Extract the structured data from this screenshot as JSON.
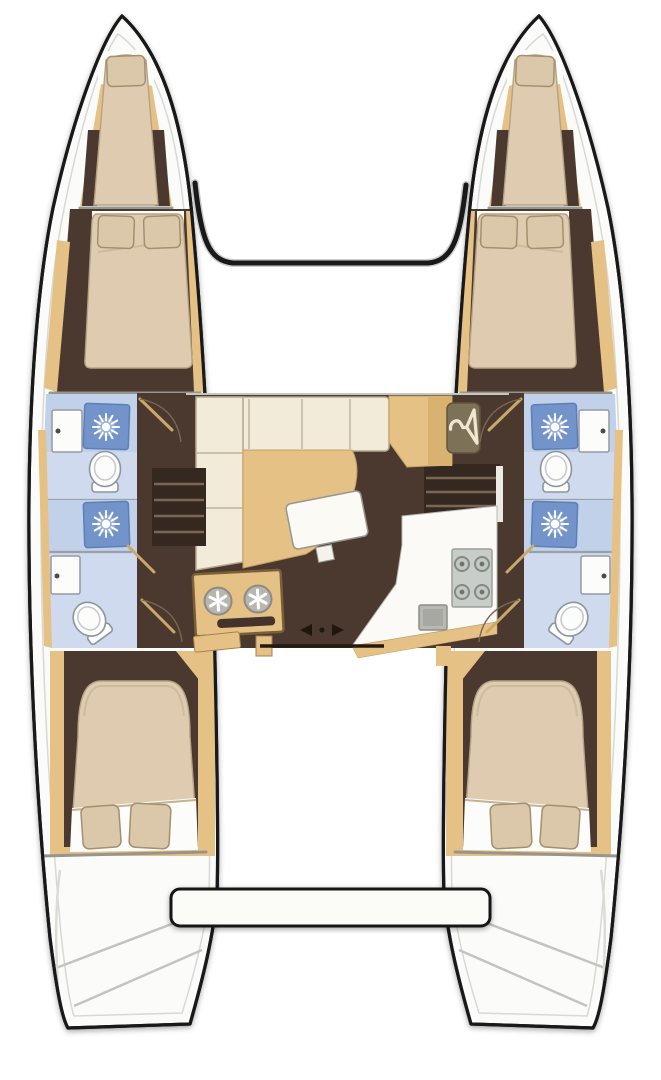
{
  "diagram": {
    "description": "Top-down floor plan of a four-cabin catamaran sailing yacht, bow at top",
    "orientation": "bow-at-top",
    "port_hull": {
      "areas": [
        "forepeak berth",
        "forward double cabin",
        "forward head with shower",
        "aft head with shower",
        "aft double cabin",
        "transom steps"
      ]
    },
    "starboard_hull": {
      "areas": [
        "forepeak berth",
        "forward double cabin",
        "forward head with shower",
        "aft head with shower",
        "aft double cabin",
        "transom steps"
      ]
    },
    "saloon": {
      "areas": [
        "L-shaped sofa",
        "chaise lounge",
        "saloon table",
        "hanging locker",
        "navigation station",
        "galley counter",
        "four-burner stove",
        "galley sink",
        "port companionway stairs",
        "starboard companionway stairs",
        "sliding door"
      ]
    },
    "structure": [
      "forward crossbeam",
      "aft platform beam"
    ],
    "icons": [
      "hanger-icon",
      "shower-icon",
      "toilet",
      "sink-faucet",
      "stove-burner",
      "slide-arrow-left-icon",
      "slide-arrow-right-icon",
      "instrument-dial"
    ],
    "counts": {
      "cabins": 4,
      "forepeak_berths": 2,
      "showers": 4,
      "toilets": 4,
      "sinks": 4
    }
  },
  "colors": {
    "wood": "#e6c185",
    "wood_dark": "#c9a05c",
    "floor_brown": "#4b3930",
    "stairs_brown": "#352820",
    "bed_beige": "#dfccb0",
    "mattress_cream": "#e8dcc8",
    "pillow_tan": "#dbc8aa",
    "sofa_cream": "#f2ebd9",
    "bath_blue": "#c1d1e9",
    "bath_blue_light": "#cfdaee",
    "shower_blue": "#7394cb",
    "fixture_white": "#fcfcfa",
    "appliance_gray": "#c9cdc9",
    "outline_black": "#191919",
    "background": "#ffffff"
  }
}
